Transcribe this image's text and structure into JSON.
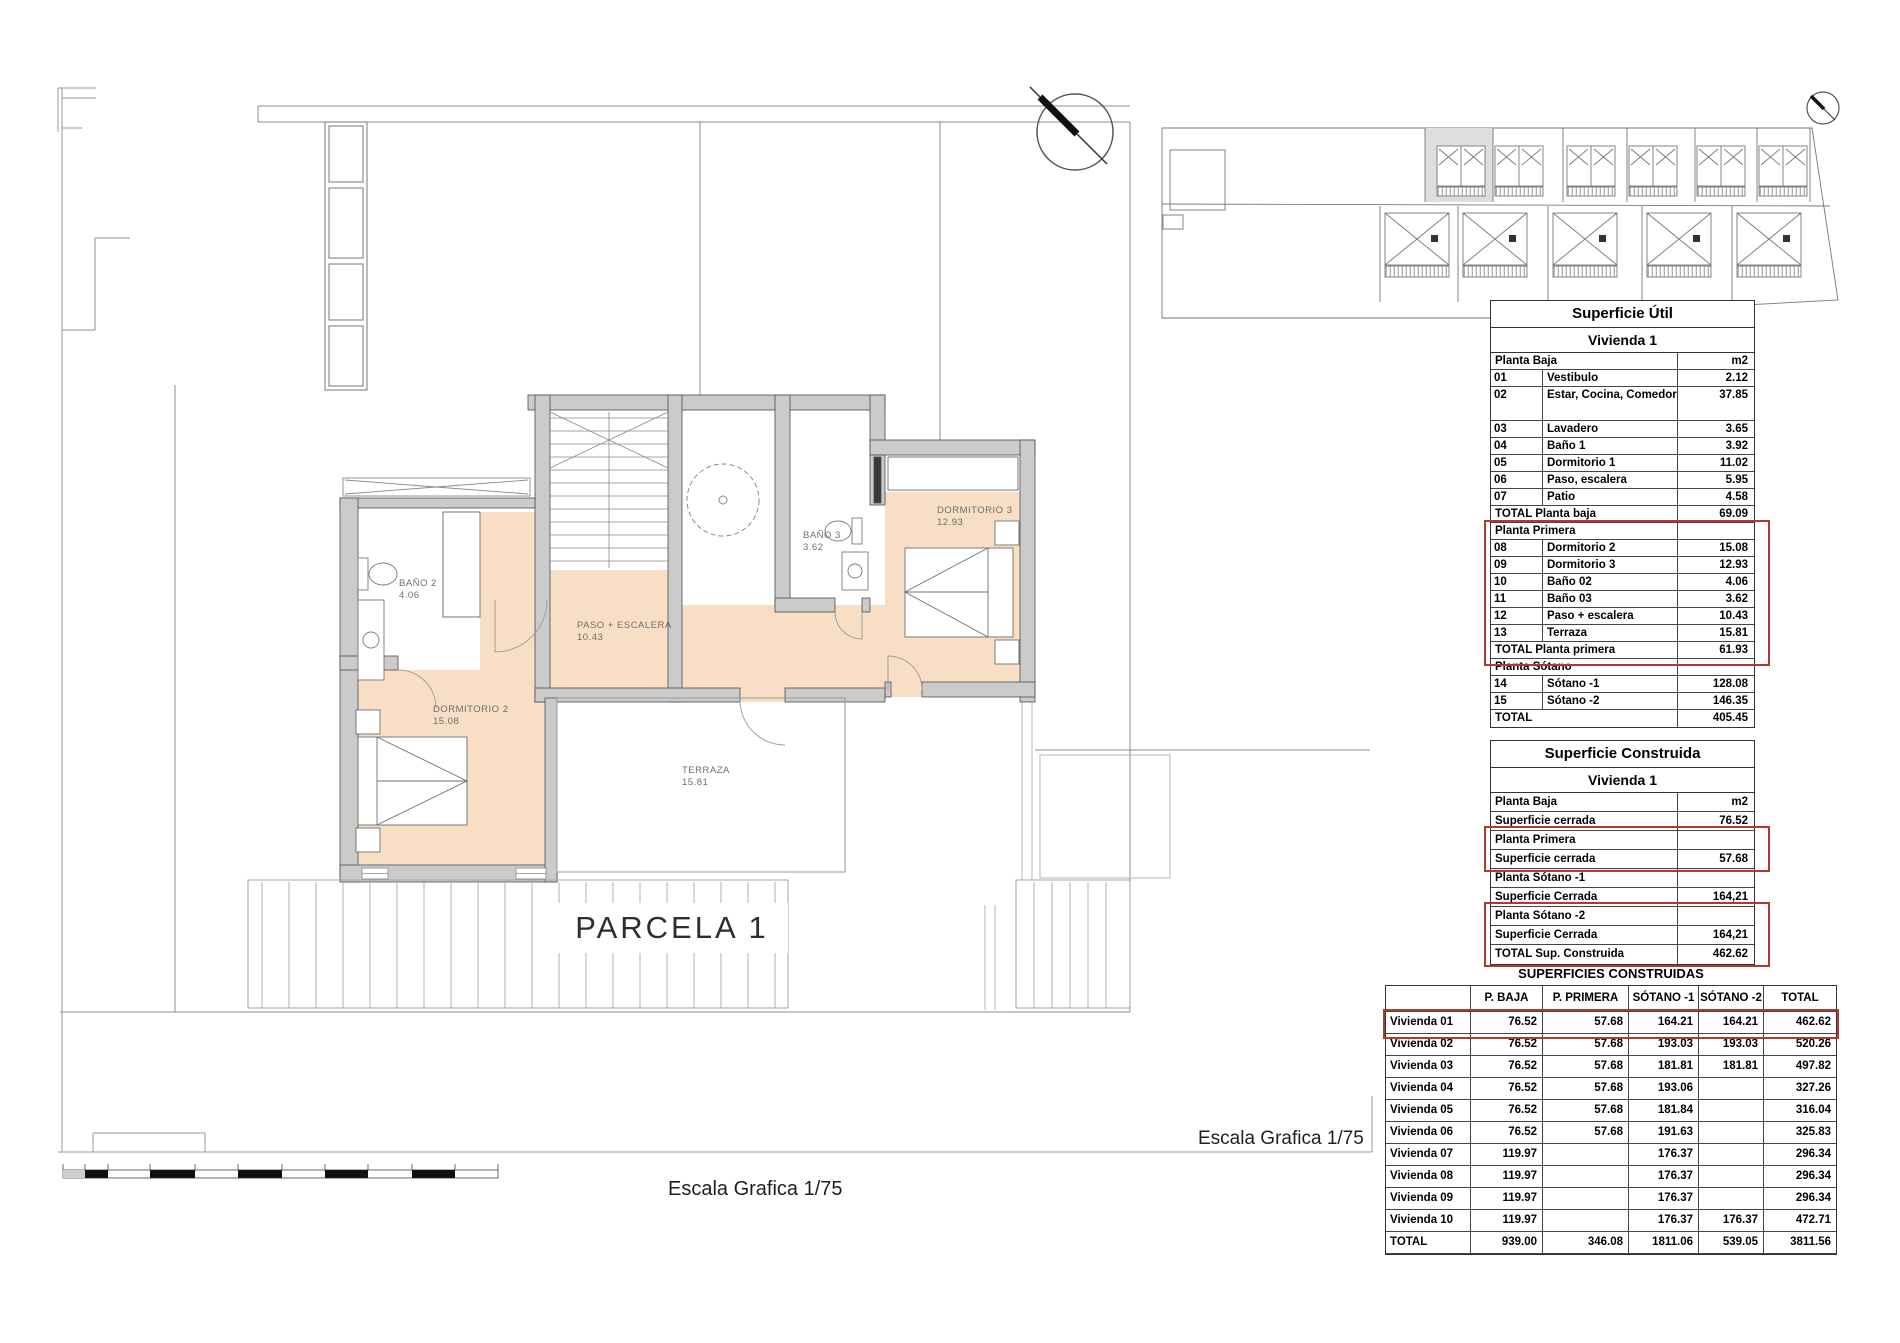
{
  "plan": {
    "parcel_label": "PARCELA 1",
    "scale_label_bottom": "Escala Grafica 1/75",
    "scale_label_right": "Escala Grafica 1/75",
    "rooms": [
      {
        "name": "BAÑO 2",
        "area": "4.06"
      },
      {
        "name": "DORMITORIO 2",
        "area": "15.08"
      },
      {
        "name": "PASO + ESCALERA",
        "area": "10.43"
      },
      {
        "name": "BAÑO 3",
        "area": "3.62"
      },
      {
        "name": "DORMITORIO 3",
        "area": "12.93"
      },
      {
        "name": "TERRAZA",
        "area": "15.81"
      }
    ],
    "colors": {
      "room_fill": "#f8dec4",
      "wall_fill": "#cbcbcb",
      "annotation_red": "#b03a2e"
    }
  },
  "tables": {
    "util": {
      "title": "Superficie Útil",
      "subtitle": "Vivienda 1",
      "rows": [
        {
          "kind": "section",
          "name": "Planta Baja",
          "value": "m2"
        },
        {
          "code": "01",
          "name": "Vestibulo",
          "value": "2.12"
        },
        {
          "kind": "tall",
          "code": "02",
          "name": "Estar, Cocina, Comedor",
          "value": "37.85"
        },
        {
          "code": "03",
          "name": "Lavadero",
          "value": "3.65"
        },
        {
          "code": "04",
          "name": "Baño 1",
          "value": "3.92"
        },
        {
          "code": "05",
          "name": "Dormitorio 1",
          "value": "11.02"
        },
        {
          "code": "06",
          "name": "Paso, escalera",
          "value": "5.95"
        },
        {
          "code": "07",
          "name": "Patio",
          "value": "4.58"
        },
        {
          "kind": "total",
          "name": "TOTAL Planta baja",
          "value": "69.09"
        },
        {
          "kind": "section",
          "name": "Planta Primera",
          "value": ""
        },
        {
          "code": "08",
          "name": "Dormitorio 2",
          "value": "15.08"
        },
        {
          "code": "09",
          "name": "Dormitorio 3",
          "value": "12.93"
        },
        {
          "code": "10",
          "name": "Baño 02",
          "value": "4.06"
        },
        {
          "code": "11",
          "name": "Baño 03",
          "value": "3.62"
        },
        {
          "code": "12",
          "name": "Paso + escalera",
          "value": "10.43"
        },
        {
          "code": "13",
          "name": "Terraza",
          "value": "15.81"
        },
        {
          "kind": "total",
          "name": "TOTAL Planta primera",
          "value": "61.93"
        },
        {
          "kind": "section",
          "name": "Planta Sótano",
          "value": ""
        },
        {
          "code": "14",
          "name": "Sótano -1",
          "value": "128.08"
        },
        {
          "code": "15",
          "name": "Sótano -2",
          "value": "146.35"
        },
        {
          "kind": "total",
          "name": "TOTAL",
          "value": "405.45"
        }
      ]
    },
    "construida": {
      "title": "Superficie Construida",
      "subtitle": "Vivienda 1",
      "rows": [
        {
          "name": "Planta Baja",
          "value": "m2"
        },
        {
          "name": "Superficie cerrada",
          "value": "76.52"
        },
        {
          "name": "Planta Primera",
          "value": ""
        },
        {
          "name": "Superficie cerrada",
          "value": "57.68"
        },
        {
          "name": "Planta Sótano -1",
          "value": ""
        },
        {
          "name": "Superficie Cerrada",
          "value": "164,21"
        },
        {
          "name": "Planta Sótano -2",
          "value": ""
        },
        {
          "name": "Superficie Cerrada",
          "value": "164,21"
        },
        {
          "name": "TOTAL Sup. Construida",
          "value": "462.62"
        }
      ]
    },
    "resumen": {
      "title": "SUPERFICIES CONSTRUIDAS",
      "columns": [
        "",
        "P. BAJA",
        "P. PRIMERA",
        "SÓTANO -1",
        "SÓTANO -2",
        "TOTAL"
      ],
      "rows": [
        {
          "label": "Vivienda 01",
          "values": [
            "76.52",
            "57.68",
            "164.21",
            "164.21",
            "462.62"
          ]
        },
        {
          "label": "Vivienda 02",
          "values": [
            "76.52",
            "57.68",
            "193.03",
            "193.03",
            "520.26"
          ]
        },
        {
          "label": "Vivienda 03",
          "values": [
            "76.52",
            "57.68",
            "181.81",
            "181.81",
            "497.82"
          ]
        },
        {
          "label": "Vivienda 04",
          "values": [
            "76.52",
            "57.68",
            "193.06",
            "",
            "327.26"
          ]
        },
        {
          "label": "Vivienda 05",
          "values": [
            "76.52",
            "57.68",
            "181.84",
            "",
            "316.04"
          ]
        },
        {
          "label": "Vivienda 06",
          "values": [
            "76.52",
            "57.68",
            "191.63",
            "",
            "325.83"
          ]
        },
        {
          "label": "Vivienda 07",
          "values": [
            "119.97",
            "",
            "176.37",
            "",
            "296.34"
          ]
        },
        {
          "label": "Vivienda 08",
          "values": [
            "119.97",
            "",
            "176.37",
            "",
            "296.34"
          ]
        },
        {
          "label": "Vivienda 09",
          "values": [
            "119.97",
            "",
            "176.37",
            "",
            "296.34"
          ]
        },
        {
          "label": "Vivienda 10",
          "values": [
            "119.97",
            "",
            "176.37",
            "176.37",
            "472.71"
          ]
        },
        {
          "label": "TOTAL",
          "values": [
            "939.00",
            "346.08",
            "1811.06",
            "539.05",
            "3811.56"
          ]
        }
      ]
    }
  }
}
